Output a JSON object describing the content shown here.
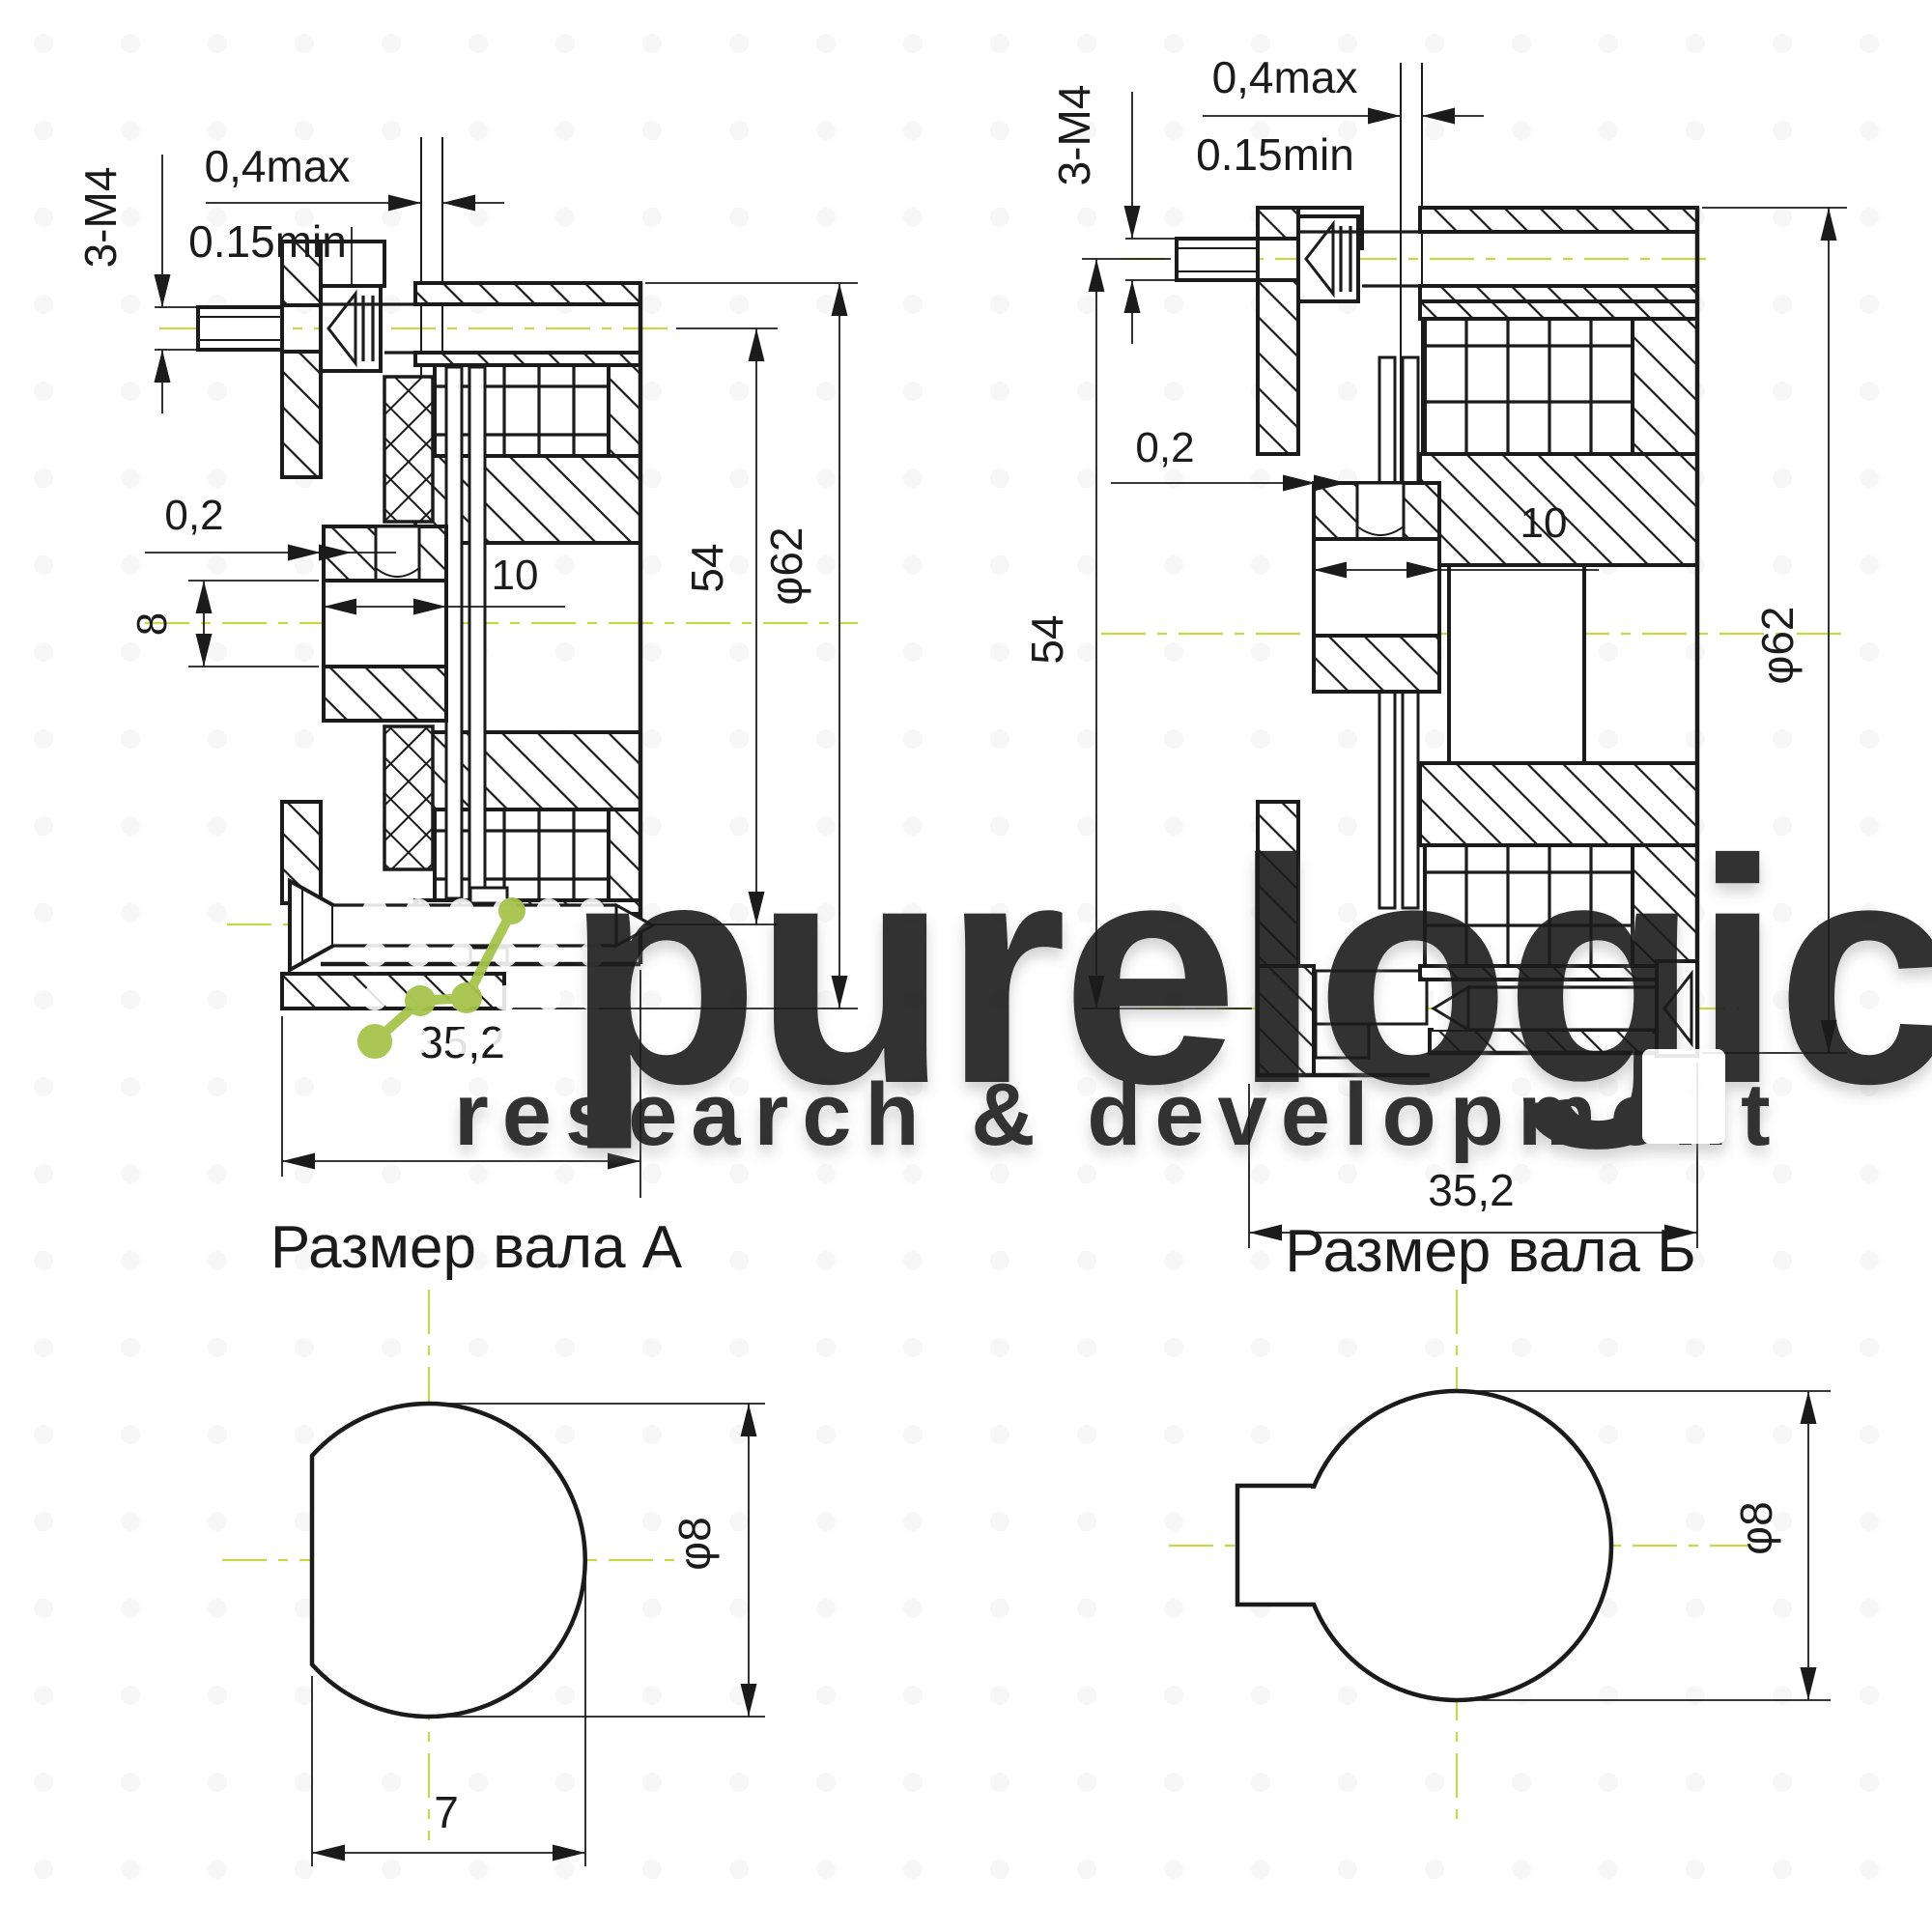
{
  "watermark": {
    "brand": "purelogic",
    "tagline": "research & development",
    "text_color": "#ffffff",
    "accent_color": "#a6c34c"
  },
  "drawing": {
    "centerline_color": "#c9d64b",
    "line_color": "#1b1b1b",
    "section_a": {
      "thread_label": "3-М4",
      "gap_max_label": "0,4max",
      "gap_min_label": "0.15min",
      "clearance_label": "0,2",
      "bore_label": "8",
      "hub_width_label": "10",
      "height_label": "54",
      "outer_dia_label": "φ62",
      "depth_label": "35,2"
    },
    "section_b": {
      "thread_label": "3-М4",
      "gap_max_label": "0,4max",
      "gap_min_label": "0.15min",
      "clearance_label": "0,2",
      "hub_width_label": "10",
      "height_label": "54",
      "outer_dia_label": "φ62",
      "depth_label": "35,2"
    },
    "shaft_a": {
      "title": "Размер вала А",
      "dia_label": "φ8",
      "flat_label": "7"
    },
    "shaft_b": {
      "title": "Размер вала Б",
      "dia_label": "φ8"
    }
  }
}
